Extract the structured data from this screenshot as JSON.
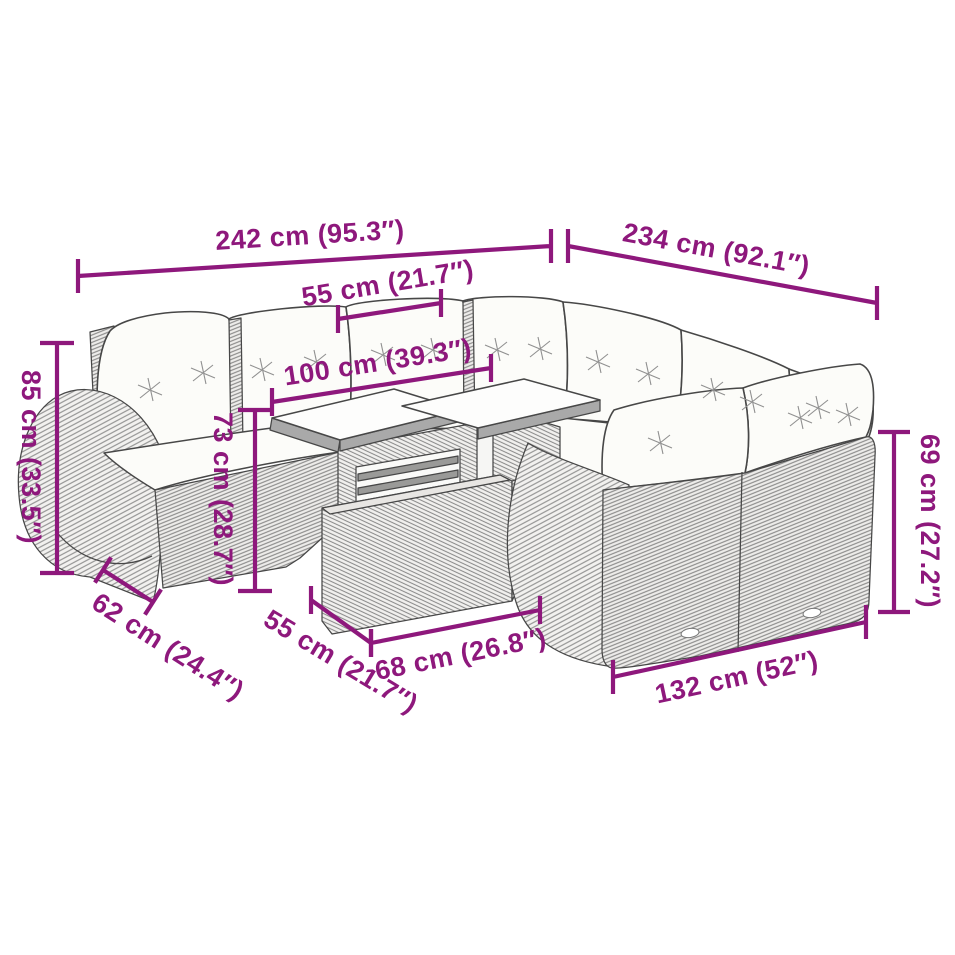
{
  "diagram": {
    "background": "#ffffff",
    "accent": "#8E187C",
    "lineart_color": "#474747",
    "cushion_color": "#fcfcf9",
    "dimensions": [
      {
        "name": "total-width-left",
        "label": "242 cm (95.3″)"
      },
      {
        "name": "total-width-right",
        "label": "234 cm (92.1″)"
      },
      {
        "name": "seat-width",
        "label": "55 cm (21.7″)"
      },
      {
        "name": "left-section-width",
        "label": "100 cm (39.3″)"
      },
      {
        "name": "backrest-height",
        "label": "85 cm (33.5″)"
      },
      {
        "name": "table-height",
        "label": "73 cm (28.7″)"
      },
      {
        "name": "sofa-depth",
        "label": "62 cm (24.4″)"
      },
      {
        "name": "table-depth",
        "label": "55 cm (21.7″)"
      },
      {
        "name": "table-width",
        "label": "68 cm (26.8″)"
      },
      {
        "name": "right-section-height",
        "label": "69 cm (27.2″)"
      },
      {
        "name": "right-section-width",
        "label": "132 cm (52″)"
      }
    ]
  }
}
